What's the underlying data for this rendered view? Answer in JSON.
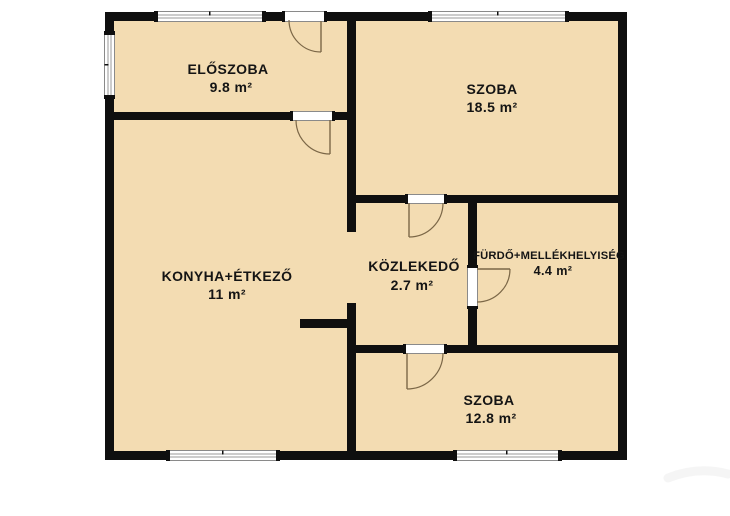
{
  "plan": {
    "title": "apartment-floor-plan",
    "colors": {
      "floor": "#f3dcb2",
      "wall": "#0f0f0f",
      "door_arc": "#7b6747",
      "background": "#ffffff"
    },
    "rooms": [
      {
        "name": "ELŐSZOBA",
        "area": "9.8 m²"
      },
      {
        "name": "SZOBA",
        "area": "18.5 m²"
      },
      {
        "name": "KONYHA+ÉTKEZŐ",
        "area": "11 m²"
      },
      {
        "name": "KÖZLEKEDŐ",
        "area": "2.7 m²"
      },
      {
        "name": "FÜRDŐ+MELLÉKHELYISÉG",
        "area": "4.4 m²"
      },
      {
        "name": "SZOBA",
        "area": "12.8 m²"
      }
    ]
  }
}
